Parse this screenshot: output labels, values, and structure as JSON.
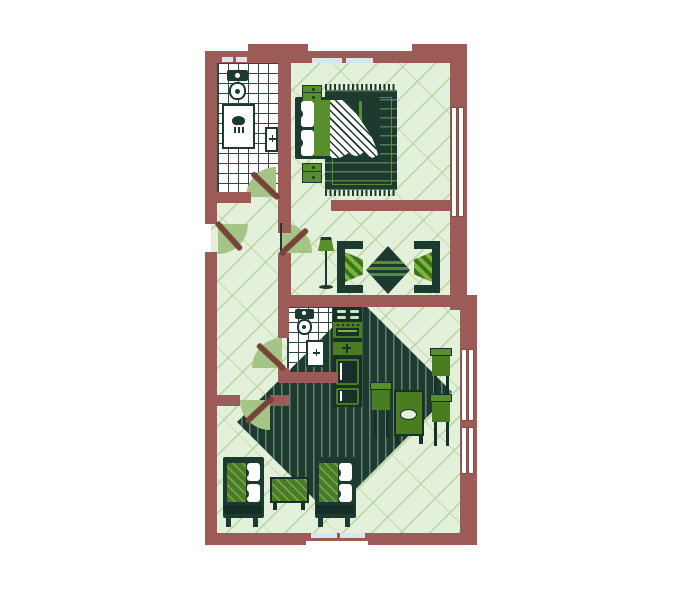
{
  "meta": {
    "title": "Two-room apartment floor plan",
    "description": "Flat-style illustrated floor plan with terracotta walls, green furniture, tiled bathrooms and patterned wood floors"
  },
  "palette": {
    "wall": "#9d5b57",
    "wall_dark": "#7b4238",
    "floor": "#e4f1da",
    "floor_line": "#b7d1a2",
    "dark_green": "#1d3a30",
    "mid_green": "#4a7d22",
    "bright_green": "#7db53c",
    "leaf_green": "#578f2e",
    "tile_line": "#2c4a40",
    "window_glass": "#d9e5ec",
    "arc_green": "#a6c487"
  },
  "rooms": [
    {
      "name": "bathroom",
      "fixtures": [
        "toilet",
        "shower",
        "washbasin"
      ]
    },
    {
      "name": "bedroom",
      "furniture": [
        "double-bed",
        "nightstand",
        "nightstand",
        "fringed-rug"
      ]
    },
    {
      "name": "hallway",
      "connects": [
        "entry",
        "bathroom",
        "wc",
        "sitting-room",
        "living-room"
      ]
    },
    {
      "name": "sitting-room",
      "furniture": [
        "floor-lamp",
        "armchair",
        "armchair",
        "diamond-ottoman-table"
      ]
    },
    {
      "name": "wc",
      "fixtures": [
        "toilet",
        "washbasin"
      ]
    },
    {
      "name": "kitchen",
      "appliances": [
        "stove",
        "oven",
        "sink",
        "refrigerator"
      ]
    },
    {
      "name": "living-dining-room",
      "furniture": [
        "dining-table",
        "dining-chair",
        "dining-chair",
        "dining-chair",
        "sofa",
        "sofa",
        "coffee-table",
        "diamond-area-rug"
      ]
    }
  ],
  "counts": {
    "doors": 5,
    "windows": 3,
    "wall_vents": 6
  }
}
